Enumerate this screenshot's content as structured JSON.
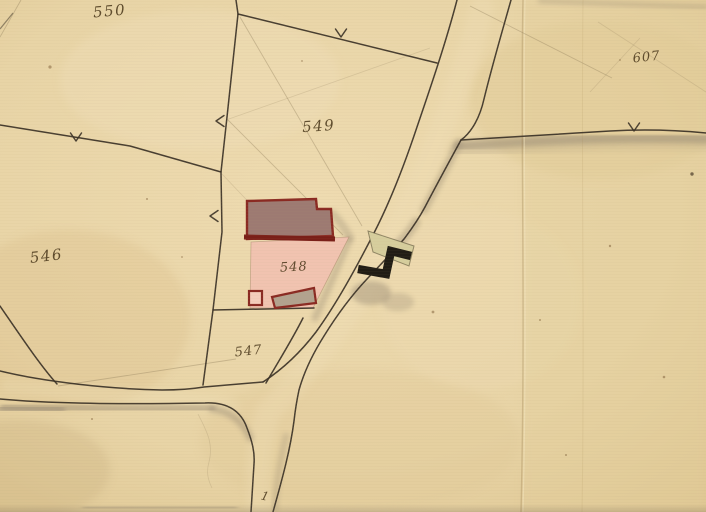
{
  "map": {
    "title": "Hand-drawn historic cadastral map sheet",
    "parcels": [
      {
        "number": "550"
      },
      {
        "number": "549"
      },
      {
        "number": "546"
      },
      {
        "number": "548"
      },
      {
        "number": "547"
      },
      {
        "number": "607"
      }
    ],
    "road_point_label": "1",
    "boundary_mark_symbol": "Y",
    "colors": {
      "paper": "#e8d4a6",
      "paper_light": "#f0e0ba",
      "paper_dark": "#dcc28c",
      "ink": "#3a3126",
      "number_ink": "#4d3b1e",
      "pencil": "#8d7c5a",
      "building_fill": "#9d7a72",
      "building_outline_red": "#8a2a22",
      "building_red_dark": "#7a1f18",
      "parcel_pink": "#f1c3b0",
      "outbuilding_gray": "#b2a28e",
      "barn_khaki": "#d6ce9d",
      "barn_black": "#211d15",
      "wash_gray": "#9b8d76"
    }
  }
}
